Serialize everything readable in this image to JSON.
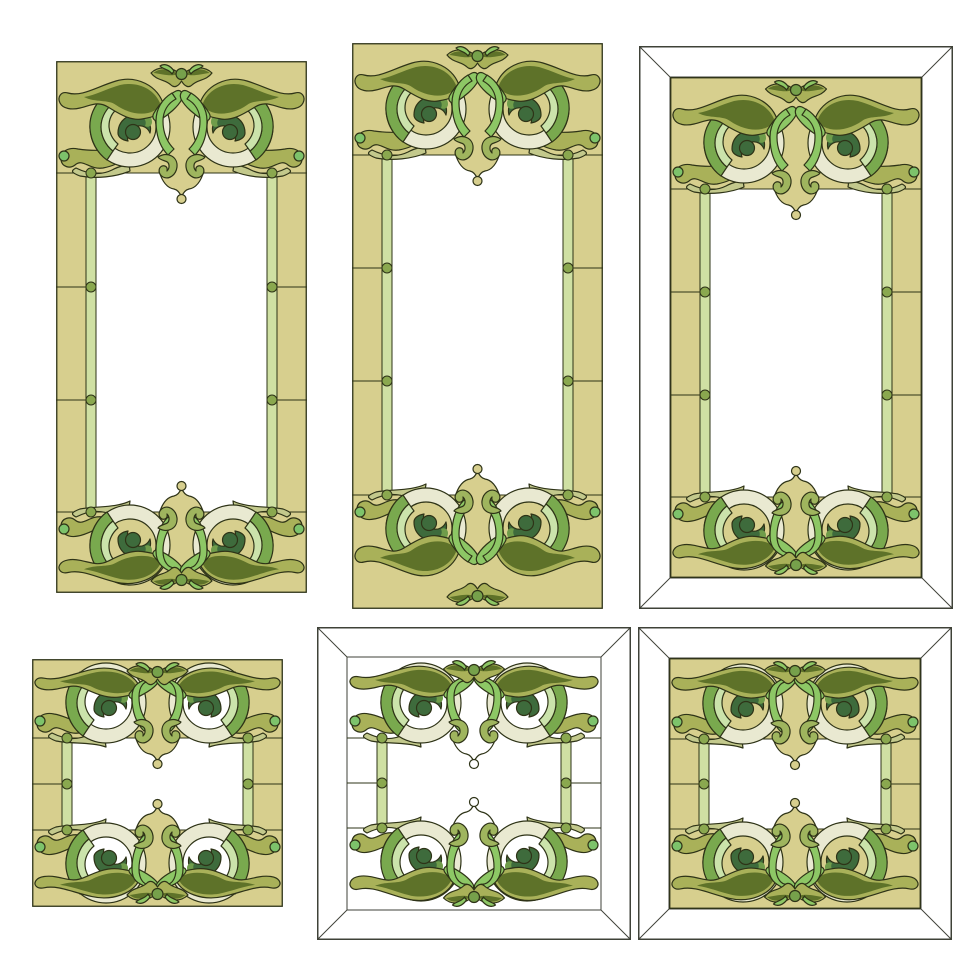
{
  "canvas": {
    "width": 980,
    "height": 980,
    "background": "#ffffff"
  },
  "artwork": {
    "kind": "stained-glass-frame-set",
    "description_elements": [
      "scroll-ring-ornament",
      "leaf-sweep",
      "liner-strip",
      "joint-dot",
      "bevel-border"
    ],
    "frame_count": 6
  },
  "palette": {
    "khaki": "#d7cf8e",
    "outline": "#2e3317",
    "bevelStroke": "#3f4238",
    "white": "#ffffff",
    "strip": "#cfe0a3",
    "dot": "#8aa84f",
    "ringPale": "#e9e9d1",
    "oliveLeaf": "#a9b159",
    "oliveDark": "#5e7229",
    "forest": "#3e6b3c",
    "medGreen": "#79a94e",
    "mint": "#cbe3ab",
    "bright": "#8dc765",
    "bulb": "#7dc36b",
    "hook": "#9fb55e",
    "waveLight": "#c3c98c",
    "budDot": "#76a14b",
    "accent": "#6f9c4a"
  },
  "frames": [
    {
      "id": "frame-tall-plain-left",
      "x": 56,
      "y": 61,
      "w": 251,
      "h": 532,
      "bevel": false,
      "t": 0,
      "khaki": true,
      "ringInterior": "khaki",
      "cyTop": 66,
      "cyBottom": 48,
      "rows": [
        112,
        226,
        339,
        451
      ]
    },
    {
      "id": "frame-tall-plain-middle",
      "x": 352,
      "y": 43,
      "w": 251,
      "h": 566,
      "bevel": false,
      "t": 0,
      "khaki": true,
      "ringInterior": "khaki",
      "cyTop": 66,
      "cyBottom": 81,
      "rows": [
        112,
        225,
        338,
        452
      ]
    },
    {
      "id": "frame-tall-bevel-right",
      "x": 639,
      "y": 46,
      "w": 314,
      "h": 563,
      "bevel": true,
      "t": 31,
      "khaki": true,
      "ringInterior": "khaki",
      "cyTop": 66,
      "cyBottom": 48,
      "rows": [
        112,
        215,
        318,
        420
      ]
    },
    {
      "id": "frame-square-plain-left",
      "x": 32,
      "y": 659,
      "w": 251,
      "h": 248,
      "bevel": false,
      "t": 0,
      "khaki": true,
      "ringInterior": "white",
      "cyTop": 44,
      "cyBottom": 44,
      "rows": [
        79,
        125,
        171
      ]
    },
    {
      "id": "frame-square-bevel-middle",
      "x": 317,
      "y": 627,
      "w": 314,
      "h": 313,
      "bevel": true,
      "t": 30,
      "khaki": false,
      "ringInterior": "white",
      "cyTop": 46,
      "cyBottom": 49,
      "rows": [
        81,
        126,
        171
      ]
    },
    {
      "id": "frame-square-bevel-right",
      "x": 638,
      "y": 627,
      "w": 314,
      "h": 313,
      "bevel": true,
      "t": 31,
      "khaki": true,
      "ringInterior": "khaki",
      "cyTop": 46,
      "cyBottom": 47,
      "rows": [
        81,
        126,
        171
      ]
    }
  ],
  "frame_geometry": {
    "borderBlock": 30,
    "stripWidth": 10,
    "dotRadius": 5,
    "ringOuterRadius": 40,
    "ringInnerRadius": 26
  }
}
